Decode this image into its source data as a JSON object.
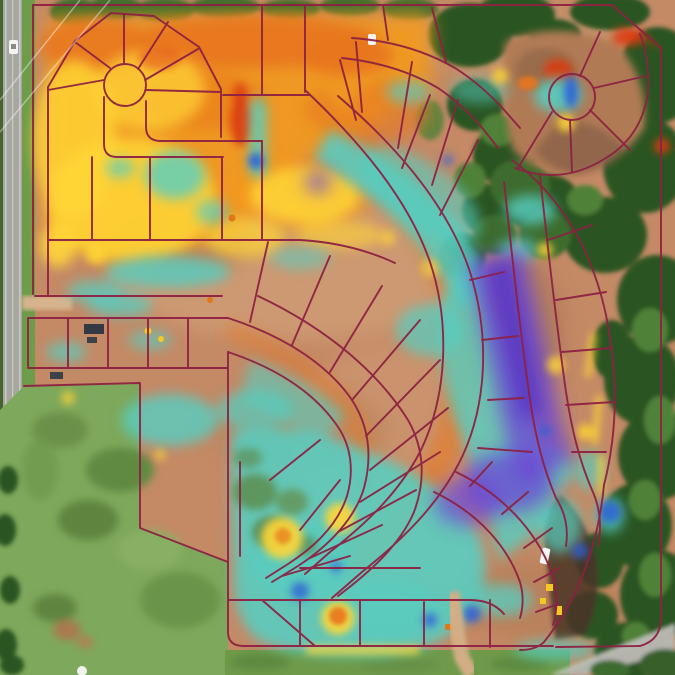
{
  "map": {
    "kind": "drone-orthomosaic-cutfill-heatmap",
    "site": "residential-subdivision-under-construction"
  },
  "palette": {
    "parcel_line": "#8e2143",
    "dirt_base": "#c48a66",
    "dirt_light": "#d9a87e",
    "dirt_dark": "#a5714d",
    "dirt_salmon": "#d09674",
    "heat_orange": "#f2991f",
    "heat_orange_deep": "#e8761c",
    "heat_yellow": "#ffd636",
    "heat_red": "#dd3b12",
    "heat_cyan": "#55cec2",
    "heat_cyan_deep": "#3dbdb8",
    "heat_purple": "#6e48d4",
    "heat_purple_core": "#5433c4",
    "heat_blue": "#2f5fd8",
    "tree_dark": "#2c5423",
    "tree_mid": "#3c6c2d",
    "tree_light": "#4f8138",
    "grass_field": "#7ea85b",
    "grass_dark": "#648f44",
    "road_gray": "#a7a7a1",
    "road_light": "#b5b5ae",
    "equip_yellow": "#f5c923",
    "equip_orange": "#e07818",
    "vehicle_white": "#f4f4f2"
  }
}
